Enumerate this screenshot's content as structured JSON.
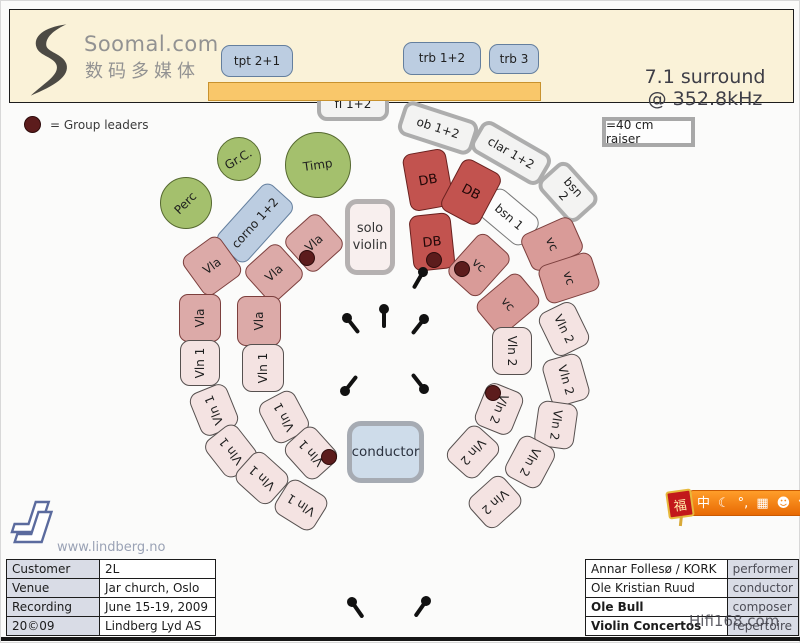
{
  "header": {
    "brand": "Soomal.com",
    "brand_cn": "数码多媒体",
    "surround_line1": "7.1 surround",
    "surround_line2": "@ 352.8kHz"
  },
  "legend": {
    "group_leaders": "= Group leaders",
    "raiser": "=40 cm raiser"
  },
  "colors": {
    "header_band": "#faf2d8",
    "riser_bar": "#f9c76a",
    "brass_blue": "#bccde1",
    "double_bass_red": "#c2534f",
    "cello_salmon": "#d99b98",
    "viola_pink": "#dcaaa8",
    "violin_light_pink": "#f4e3e2",
    "percussion_green": "#a4c06d",
    "leader_dot": "#5c1c1c"
  },
  "seats": [
    {
      "label": "tpt 2+1",
      "type": "brass",
      "x": 220,
      "y": 44,
      "w": 72,
      "h": 32,
      "rot": 0
    },
    {
      "label": "trb 1+2",
      "type": "brass",
      "x": 402,
      "y": 41,
      "w": 78,
      "h": 33,
      "rot": 0
    },
    {
      "label": "trb 3",
      "type": "brass",
      "x": 488,
      "y": 43,
      "w": 50,
      "h": 30,
      "rot": 0
    },
    {
      "label": "corno 1+2",
      "type": "brass",
      "x": 214,
      "y": 202,
      "w": 80,
      "h": 40,
      "rot": -48
    },
    {
      "label": "fl 1+2",
      "type": "wood",
      "x": 316,
      "y": 87,
      "w": 72,
      "h": 33,
      "rot": 0
    },
    {
      "label": "ob 1+2",
      "type": "wood",
      "x": 398,
      "y": 109,
      "w": 78,
      "h": 36,
      "rot": 18
    },
    {
      "label": "clar 1+2",
      "type": "wood",
      "x": 470,
      "y": 134,
      "w": 80,
      "h": 36,
      "rot": 30
    },
    {
      "label": "bsn\n2",
      "type": "wood",
      "x": 539,
      "y": 171,
      "w": 56,
      "h": 40,
      "rot": 48
    },
    {
      "label": "bsn 1",
      "type": "wood-thin",
      "x": 479,
      "y": 198,
      "w": 58,
      "h": 36,
      "rot": 40
    },
    {
      "label": "DB",
      "type": "db",
      "x": 405,
      "y": 150,
      "w": 44,
      "h": 58,
      "rot": -10
    },
    {
      "label": "DB",
      "type": "db",
      "x": 448,
      "y": 162,
      "w": 44,
      "h": 58,
      "rot": 28
    },
    {
      "label": "DB",
      "type": "db",
      "x": 410,
      "y": 213,
      "w": 42,
      "h": 56,
      "rot": -6
    },
    {
      "label": "vc",
      "type": "vc",
      "x": 457,
      "y": 236,
      "w": 42,
      "h": 56,
      "rot": 42
    },
    {
      "label": "vc",
      "type": "vc",
      "x": 531,
      "y": 215,
      "w": 40,
      "h": 56,
      "rot": 66
    },
    {
      "label": "vc",
      "type": "vc",
      "x": 486,
      "y": 275,
      "w": 42,
      "h": 56,
      "rot": 50
    },
    {
      "label": "vc",
      "type": "vc",
      "x": 548,
      "y": 249,
      "w": 40,
      "h": 56,
      "rot": 72
    },
    {
      "label": "Vla",
      "type": "vla",
      "x": 290,
      "y": 219,
      "w": 46,
      "h": 46,
      "rot": -42
    },
    {
      "label": "Vla",
      "type": "vla",
      "x": 250,
      "y": 249,
      "w": 46,
      "h": 46,
      "rot": -42
    },
    {
      "label": "Vla",
      "type": "vla",
      "x": 188,
      "y": 241,
      "w": 46,
      "h": 48,
      "rot": -36
    },
    {
      "label": "Vla",
      "type": "vla",
      "x": 175,
      "y": 296,
      "w": 48,
      "h": 42,
      "rot": -90
    },
    {
      "label": "Vla",
      "type": "vla",
      "x": 233,
      "y": 298,
      "w": 50,
      "h": 44,
      "rot": -90
    },
    {
      "label": "Vln 1",
      "type": "vln",
      "x": 176,
      "y": 342,
      "w": 46,
      "h": 40,
      "rot": -90
    },
    {
      "label": "Vln 1",
      "type": "vln",
      "x": 238,
      "y": 346,
      "w": 48,
      "h": 42,
      "rot": -90
    },
    {
      "label": "Vln 1",
      "type": "vln",
      "x": 190,
      "y": 389,
      "w": 46,
      "h": 40,
      "rot": -112
    },
    {
      "label": "Vln 1",
      "type": "vln",
      "x": 260,
      "y": 396,
      "w": 46,
      "h": 40,
      "rot": -118
    },
    {
      "label": "Vln 1",
      "type": "vln",
      "x": 207,
      "y": 430,
      "w": 46,
      "h": 40,
      "rot": -128
    },
    {
      "label": "Vln 1",
      "type": "vln",
      "x": 287,
      "y": 432,
      "w": 46,
      "h": 40,
      "rot": -132
    },
    {
      "label": "Vln 1",
      "type": "vln",
      "x": 238,
      "y": 457,
      "w": 46,
      "h": 40,
      "rot": -138
    },
    {
      "label": "Vln 1",
      "type": "vln",
      "x": 277,
      "y": 484,
      "w": 46,
      "h": 40,
      "rot": -148
    },
    {
      "label": "Vln 2",
      "type": "vln",
      "x": 539,
      "y": 308,
      "w": 48,
      "h": 40,
      "rot": 64
    },
    {
      "label": "Vln 2",
      "type": "vln",
      "x": 487,
      "y": 330,
      "w": 48,
      "h": 40,
      "rot": 90
    },
    {
      "label": "Vln 2",
      "type": "vln",
      "x": 541,
      "y": 359,
      "w": 48,
      "h": 40,
      "rot": 74
    },
    {
      "label": "Vln 2",
      "type": "vln",
      "x": 475,
      "y": 388,
      "w": 46,
      "h": 40,
      "rot": 112
    },
    {
      "label": "Vln 2",
      "type": "vln",
      "x": 532,
      "y": 404,
      "w": 46,
      "h": 40,
      "rot": 98
    },
    {
      "label": "Vln 2",
      "type": "vln",
      "x": 449,
      "y": 431,
      "w": 46,
      "h": 40,
      "rot": 132
    },
    {
      "label": "Vln 2",
      "type": "vln",
      "x": 506,
      "y": 441,
      "w": 46,
      "h": 40,
      "rot": 118
    },
    {
      "label": "Vln 2",
      "type": "vln",
      "x": 471,
      "y": 481,
      "w": 46,
      "h": 40,
      "rot": 138
    },
    {
      "label": "solo\nviolin",
      "type": "solo",
      "x": 344,
      "y": 198,
      "w": 50,
      "h": 76,
      "rot": 0
    },
    {
      "label": "conductor",
      "type": "conductor",
      "x": 346,
      "y": 420,
      "w": 77,
      "h": 62,
      "rot": 0
    }
  ],
  "circles": [
    {
      "label": "Perc",
      "x": 159,
      "y": 176,
      "d": 52,
      "trot": -45
    },
    {
      "label": "Gr.C.",
      "x": 216,
      "y": 136,
      "d": 44,
      "trot": -30
    },
    {
      "label": "Timp",
      "x": 284,
      "y": 131,
      "d": 66,
      "trot": -8
    }
  ],
  "mics": [
    {
      "x": 383,
      "y": 308,
      "rot": 0
    },
    {
      "x": 346,
      "y": 317,
      "rot": -38
    },
    {
      "x": 423,
      "y": 318,
      "rot": 38
    },
    {
      "x": 344,
      "y": 390,
      "rot": -142
    },
    {
      "x": 423,
      "y": 388,
      "rot": 142
    },
    {
      "x": 422,
      "y": 271,
      "rot": 30
    },
    {
      "x": 351,
      "y": 601,
      "rot": -35
    },
    {
      "x": 425,
      "y": 600,
      "rot": 35
    }
  ],
  "leader_dots": [
    {
      "x": 433,
      "y": 259
    },
    {
      "x": 461,
      "y": 268
    },
    {
      "x": 306,
      "y": 257
    },
    {
      "x": 328,
      "y": 456
    },
    {
      "x": 492,
      "y": 392
    }
  ],
  "info_table": {
    "rows": [
      {
        "label": "Customer",
        "value": "2L"
      },
      {
        "label": "Venue",
        "value": "Jar church, Oslo"
      },
      {
        "label": "Recording",
        "value": "June 15-19, 2009"
      },
      {
        "label": "20©09",
        "value": "Lindberg Lyd AS"
      }
    ]
  },
  "credits_table": {
    "rows": [
      {
        "name": "Annar Follesø / KORK",
        "role": "performer",
        "bold": false
      },
      {
        "name": "Ole Kristian Ruud",
        "role": "conductor",
        "bold": false
      },
      {
        "name": "Ole Bull",
        "role": "composer",
        "bold": true
      },
      {
        "name": "Violin Concertos",
        "role": "repertoire",
        "bold": true
      }
    ]
  },
  "footer": {
    "website": "www.lindberg.no",
    "watermark": "Hifi168.com"
  },
  "ime": {
    "charm": "福",
    "icons": [
      "中",
      "☾",
      "°,",
      "▦",
      "☻",
      "⚒"
    ]
  }
}
